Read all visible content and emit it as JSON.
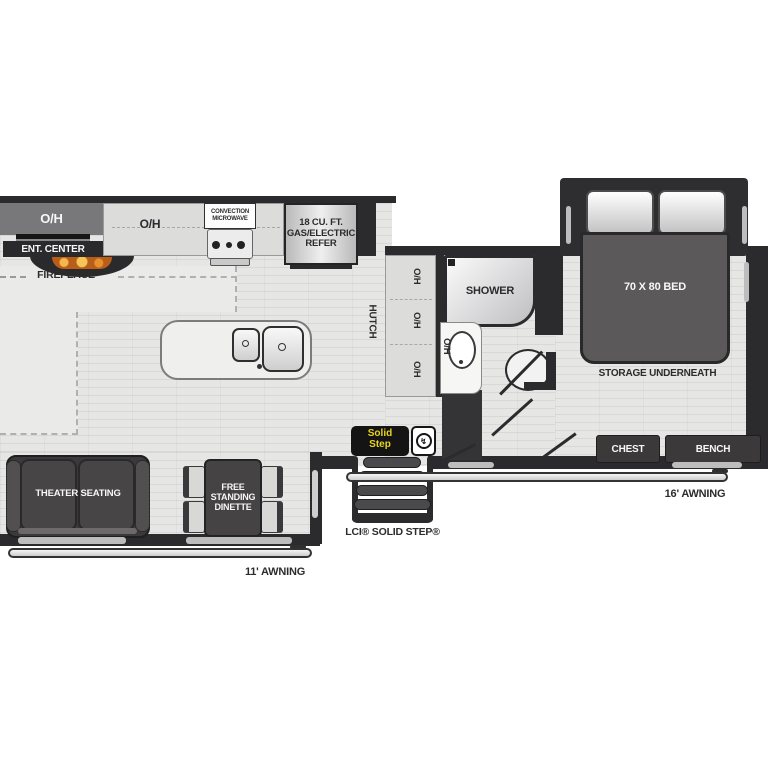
{
  "colors": {
    "wall": "#2b2b2d",
    "floor": "#e6e6e5",
    "counter": "#dcdcdb",
    "dark_furniture": "#3b393a",
    "bed": "#5b5959",
    "accent_yellow": "#e9d41f",
    "flame_orange": "#e07a1f"
  },
  "kitchen": {
    "overhead_cabinet": "O/H",
    "entertainment_center": "ENT. CENTER",
    "fireplace": "FIREPLACE",
    "counter_overhead": "O/H",
    "microwave": "CONVECTION MICROWAVE",
    "refrigerator": "18 CU. FT. GAS/ELECTRIC REFER"
  },
  "hutch": {
    "label": "HUTCH",
    "overheads": [
      "O/H",
      "O/H",
      "O/H"
    ]
  },
  "bathroom": {
    "shower": "SHOWER",
    "sink_overhead": "O/H"
  },
  "bedroom": {
    "bed": "70 X 80 BED",
    "storage": "STORAGE UNDERNEATH",
    "chest": "CHEST",
    "bench": "BENCH"
  },
  "living": {
    "theater_seating": "THEATER SEATING",
    "dinette": "FREE STANDING DINETTE"
  },
  "entry": {
    "brand_top": "Solid",
    "brand_bottom": "Step",
    "step_label": "LCI® SOLID STEP®"
  },
  "awnings": {
    "right": "16' AWNING",
    "left": "11' AWNING"
  },
  "icons": {
    "lci_mark": "↯"
  }
}
